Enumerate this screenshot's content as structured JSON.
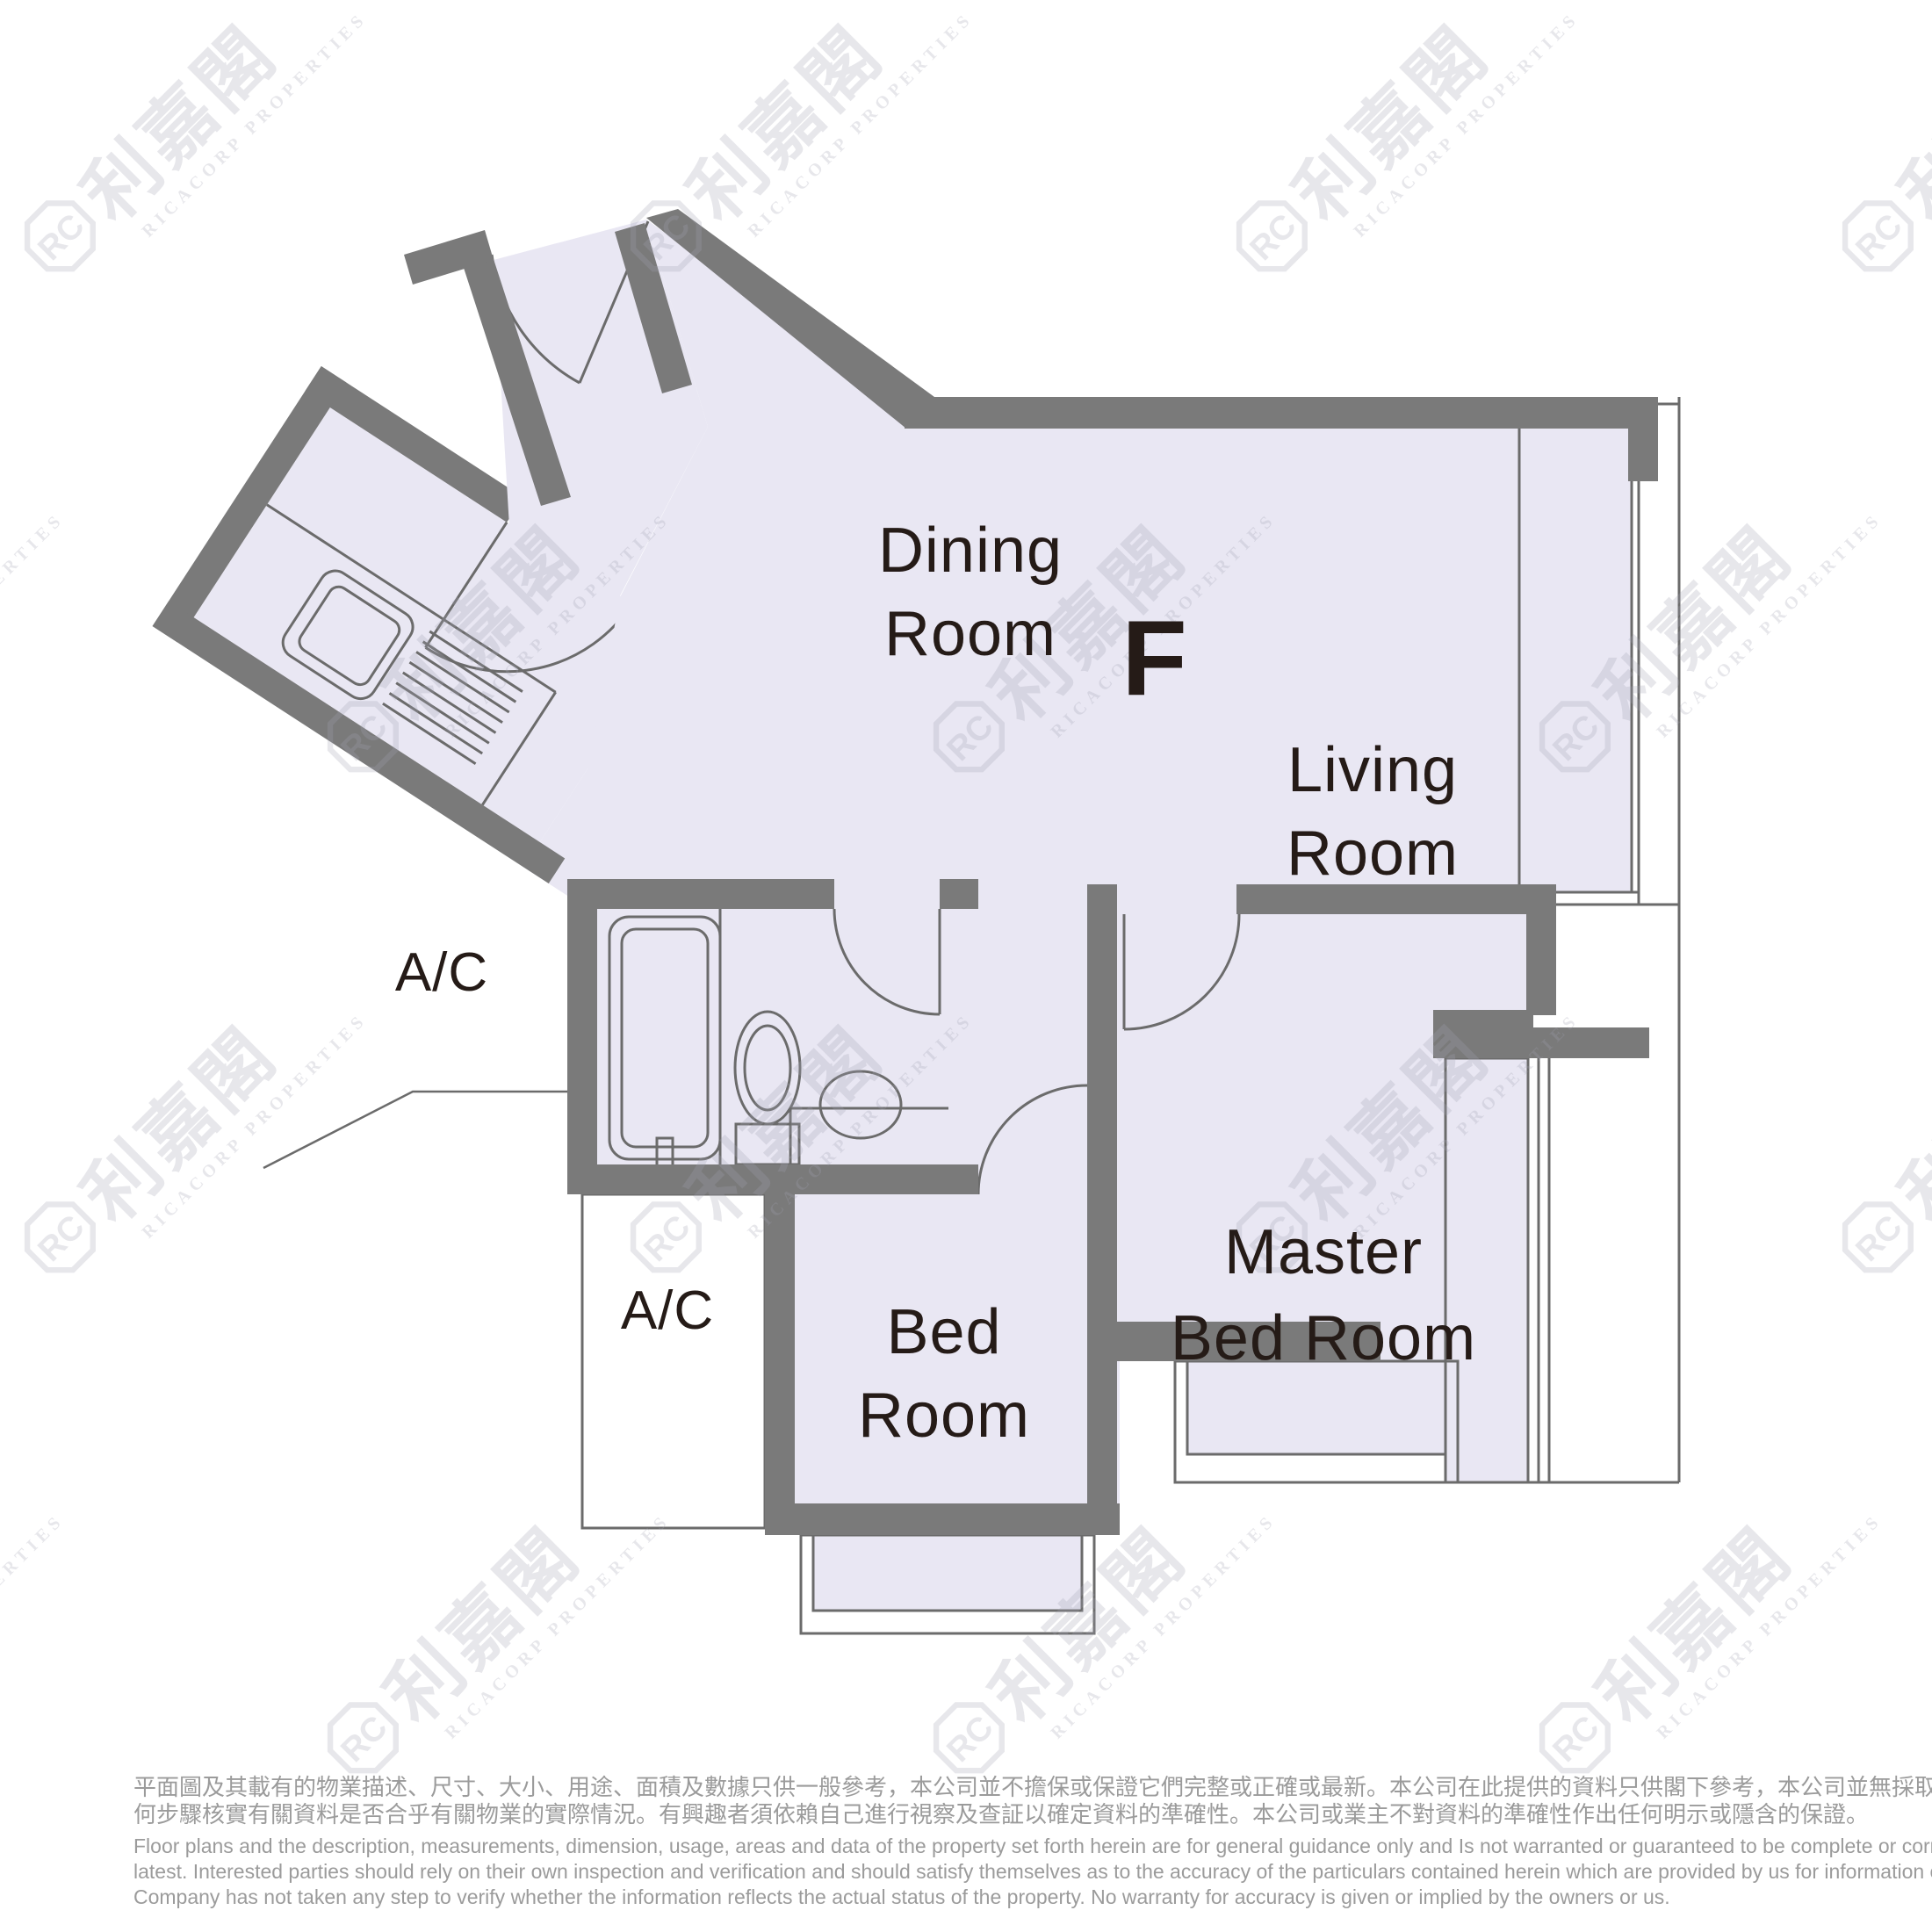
{
  "plan": {
    "unit_label": "F",
    "rooms": {
      "dining": {
        "line1": "Dining",
        "line2": "Room"
      },
      "living": {
        "line1": "Living",
        "line2": "Room"
      },
      "master": {
        "line1": "Master",
        "line2": "Bed Room"
      },
      "bed": {
        "line1": "Bed",
        "line2": "Room"
      }
    },
    "ac_label_1": "A/C",
    "ac_label_2": "A/C"
  },
  "watermark": {
    "logo_text": "RC",
    "cjk": "利嘉閣",
    "en": "RICACORP PROPERTIES"
  },
  "disclaimer": {
    "zh_lines": [
      "平面圖及其載有的物業描述、尺寸、大小、用途、面積及數據只供一般參考，本公司並不擔保或保證它們完整或正確或最新。本公司在此提供的資料只供閣下參考，本公司並無採取任",
      "何步驟核實有關資料是否合乎有關物業的實際情況。有興趣者須依賴自己進行視察及查証以確定資料的準確性。本公司或業主不對資料的準確性作出任何明示或隱含的保證。"
    ],
    "en_lines": [
      "Floor plans and the description, measurements, dimension, usage, areas and data of the property set forth herein are for general guidance only and Is not warranted or guaranteed to be complete or correct or the",
      "latest. Interested parties should rely on their own inspection and verification and should satisfy themselves as to the accuracy of the particulars contained herein which are provided by us for information only.  Our",
      "Company has not taken any step to verify whether the information reflects the actual status of the property.  No warranty for accuracy is given or implied by the owners or us."
    ]
  },
  "colors": {
    "wall": "#7a7a7a",
    "floor": "#e9e7f3",
    "line": "#6b6b6b",
    "label_text": "#251b17",
    "disclaimer_text": "#9b9b9b",
    "background": "#ffffff"
  }
}
